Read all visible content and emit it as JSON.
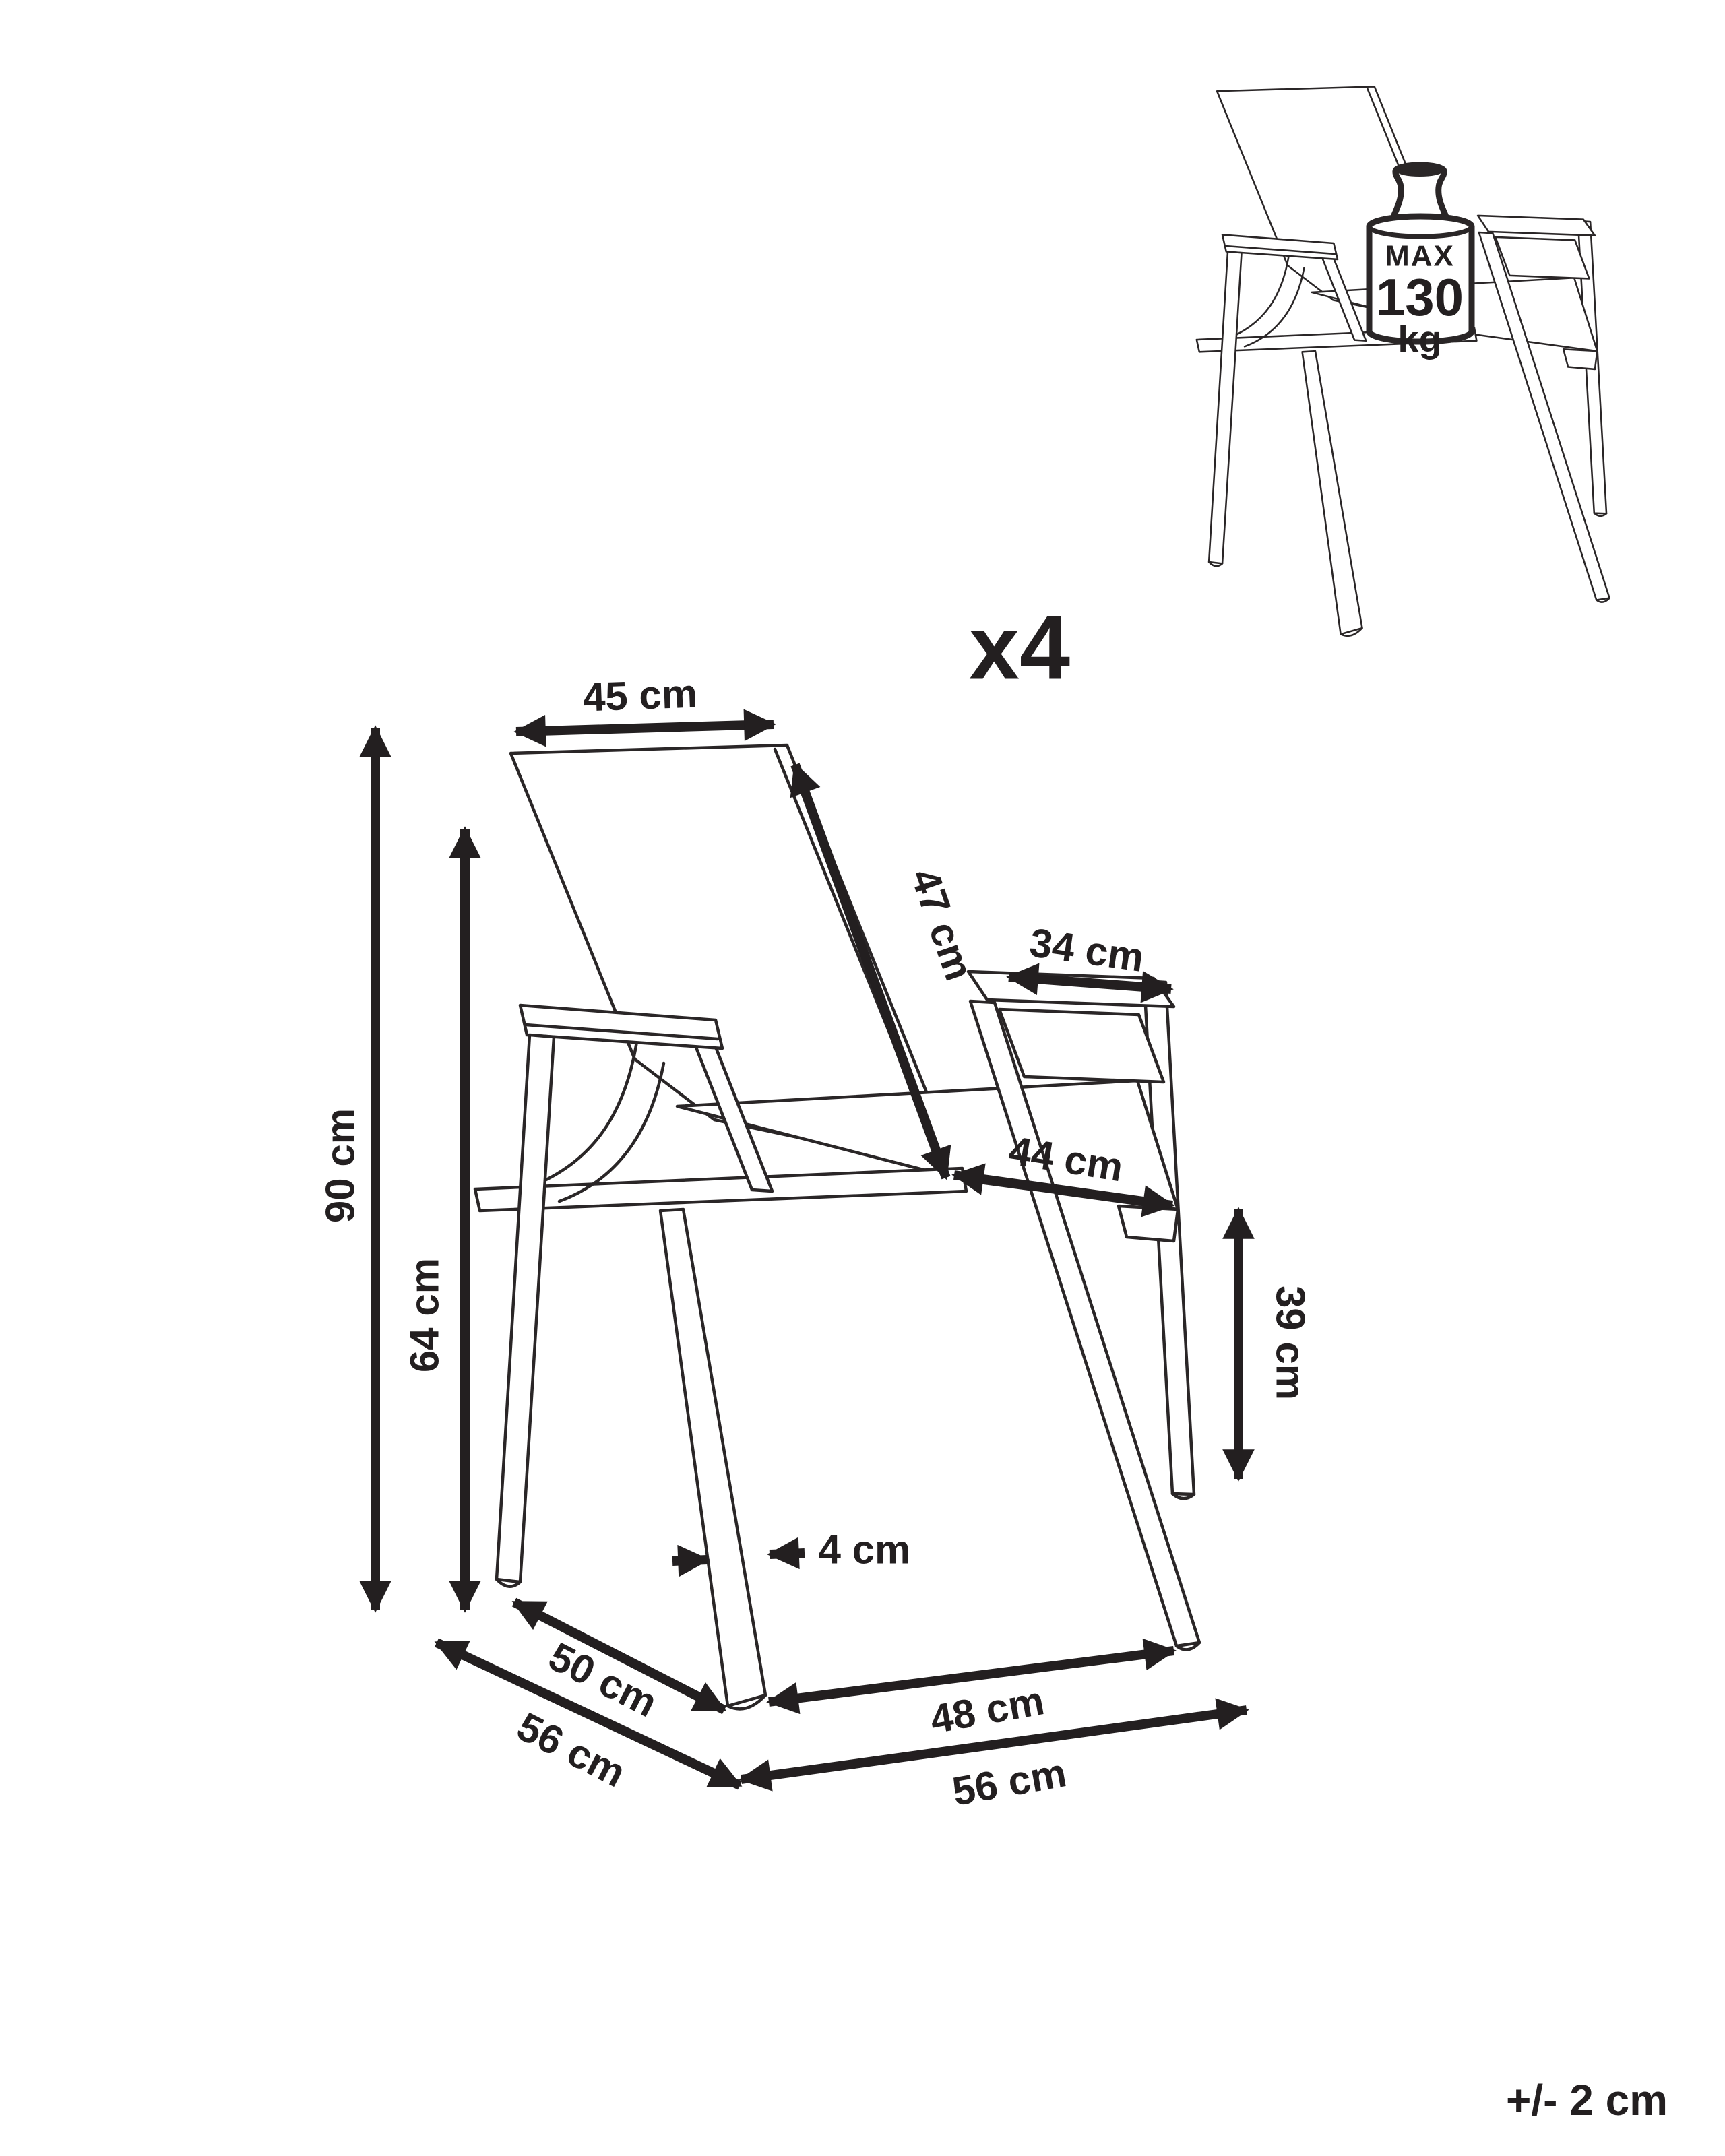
{
  "diagram": {
    "quantity_label": "x4",
    "tolerance_label": "+/- 2 cm",
    "max_load": {
      "label": "MAX",
      "value": "130",
      "unit": "kg"
    },
    "dimensions": {
      "backrest_width": "45 cm",
      "backrest_height": "47 cm",
      "armrest_length": "34 cm",
      "seat_depth": "44 cm",
      "overall_height": "90 cm",
      "armrest_height": "64 cm",
      "seat_height": "39 cm",
      "frame_thickness": "4 cm",
      "seat_depth_base": "50 cm",
      "overall_depth": "56 cm",
      "seat_width": "48 cm",
      "overall_width": "56 cm"
    }
  }
}
